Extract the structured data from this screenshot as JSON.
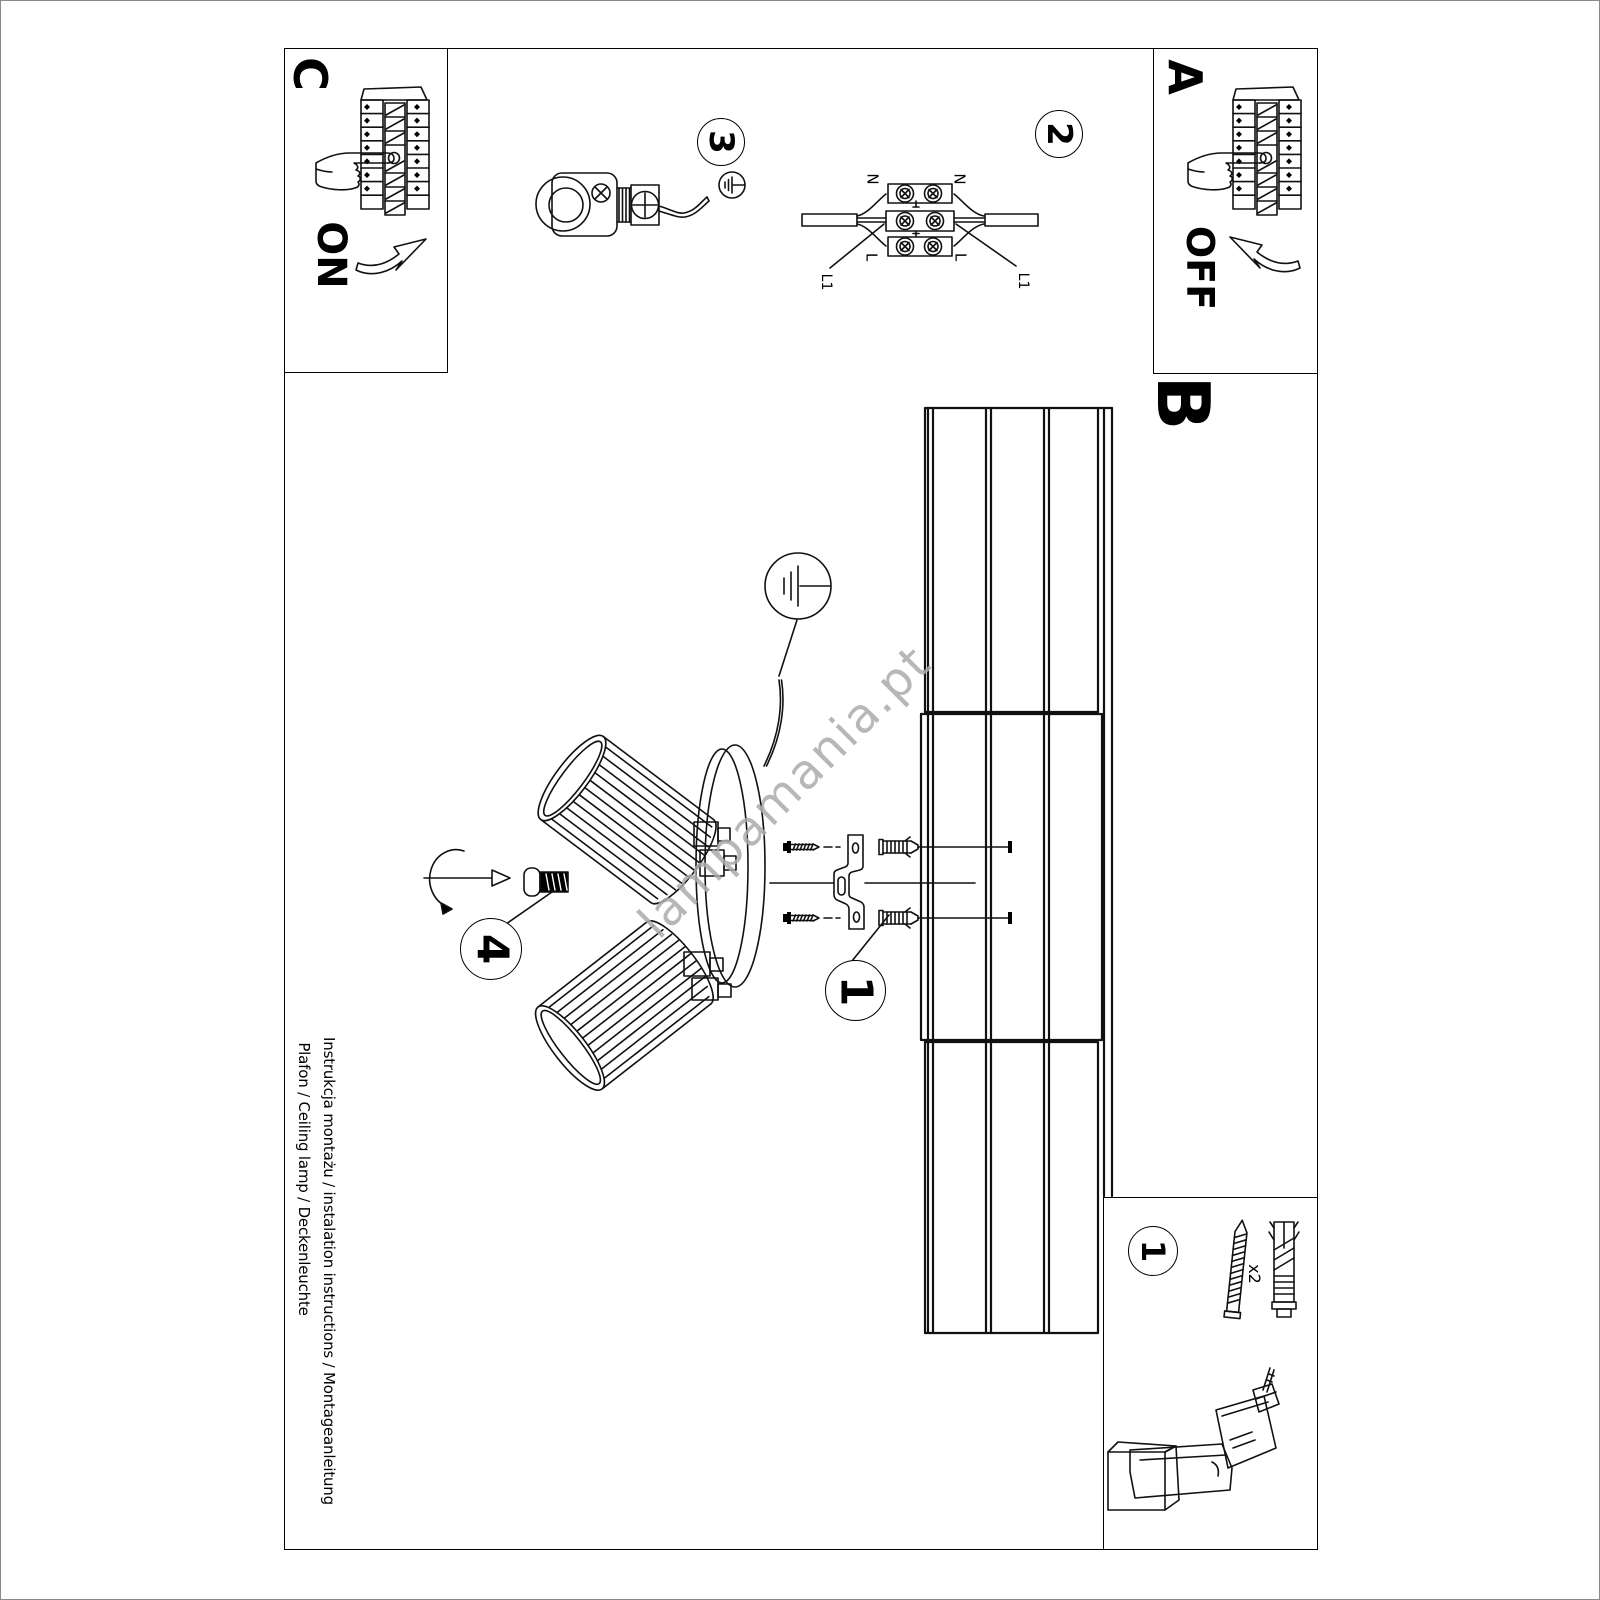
{
  "title_block": {
    "line1": "Instrukcja montażu / instalation instructions / Montageanleitung",
    "line2": "Plafon / Ceiling lamp / Deckenleuchte"
  },
  "watermark": {
    "text": "lampamania.pt",
    "color": "#ababab"
  },
  "sections": {
    "power_on": {
      "label": "C",
      "state": "ON"
    },
    "power_off": {
      "label": "A",
      "state": "OFF"
    },
    "mounting": {
      "label": "B"
    }
  },
  "steps": {
    "anchors": "1",
    "wiring": "2",
    "ground": "3",
    "shade": "4",
    "parts_box": "1"
  },
  "wiring_labels": {
    "n_left": "N",
    "n_right": "N",
    "l_left": "L",
    "l_right": "L",
    "l1_left": "L1",
    "l1_right": "L1"
  },
  "parts": {
    "screw_qty": "x2"
  },
  "colors": {
    "ink": "#000000",
    "watermark": "#ababab"
  }
}
